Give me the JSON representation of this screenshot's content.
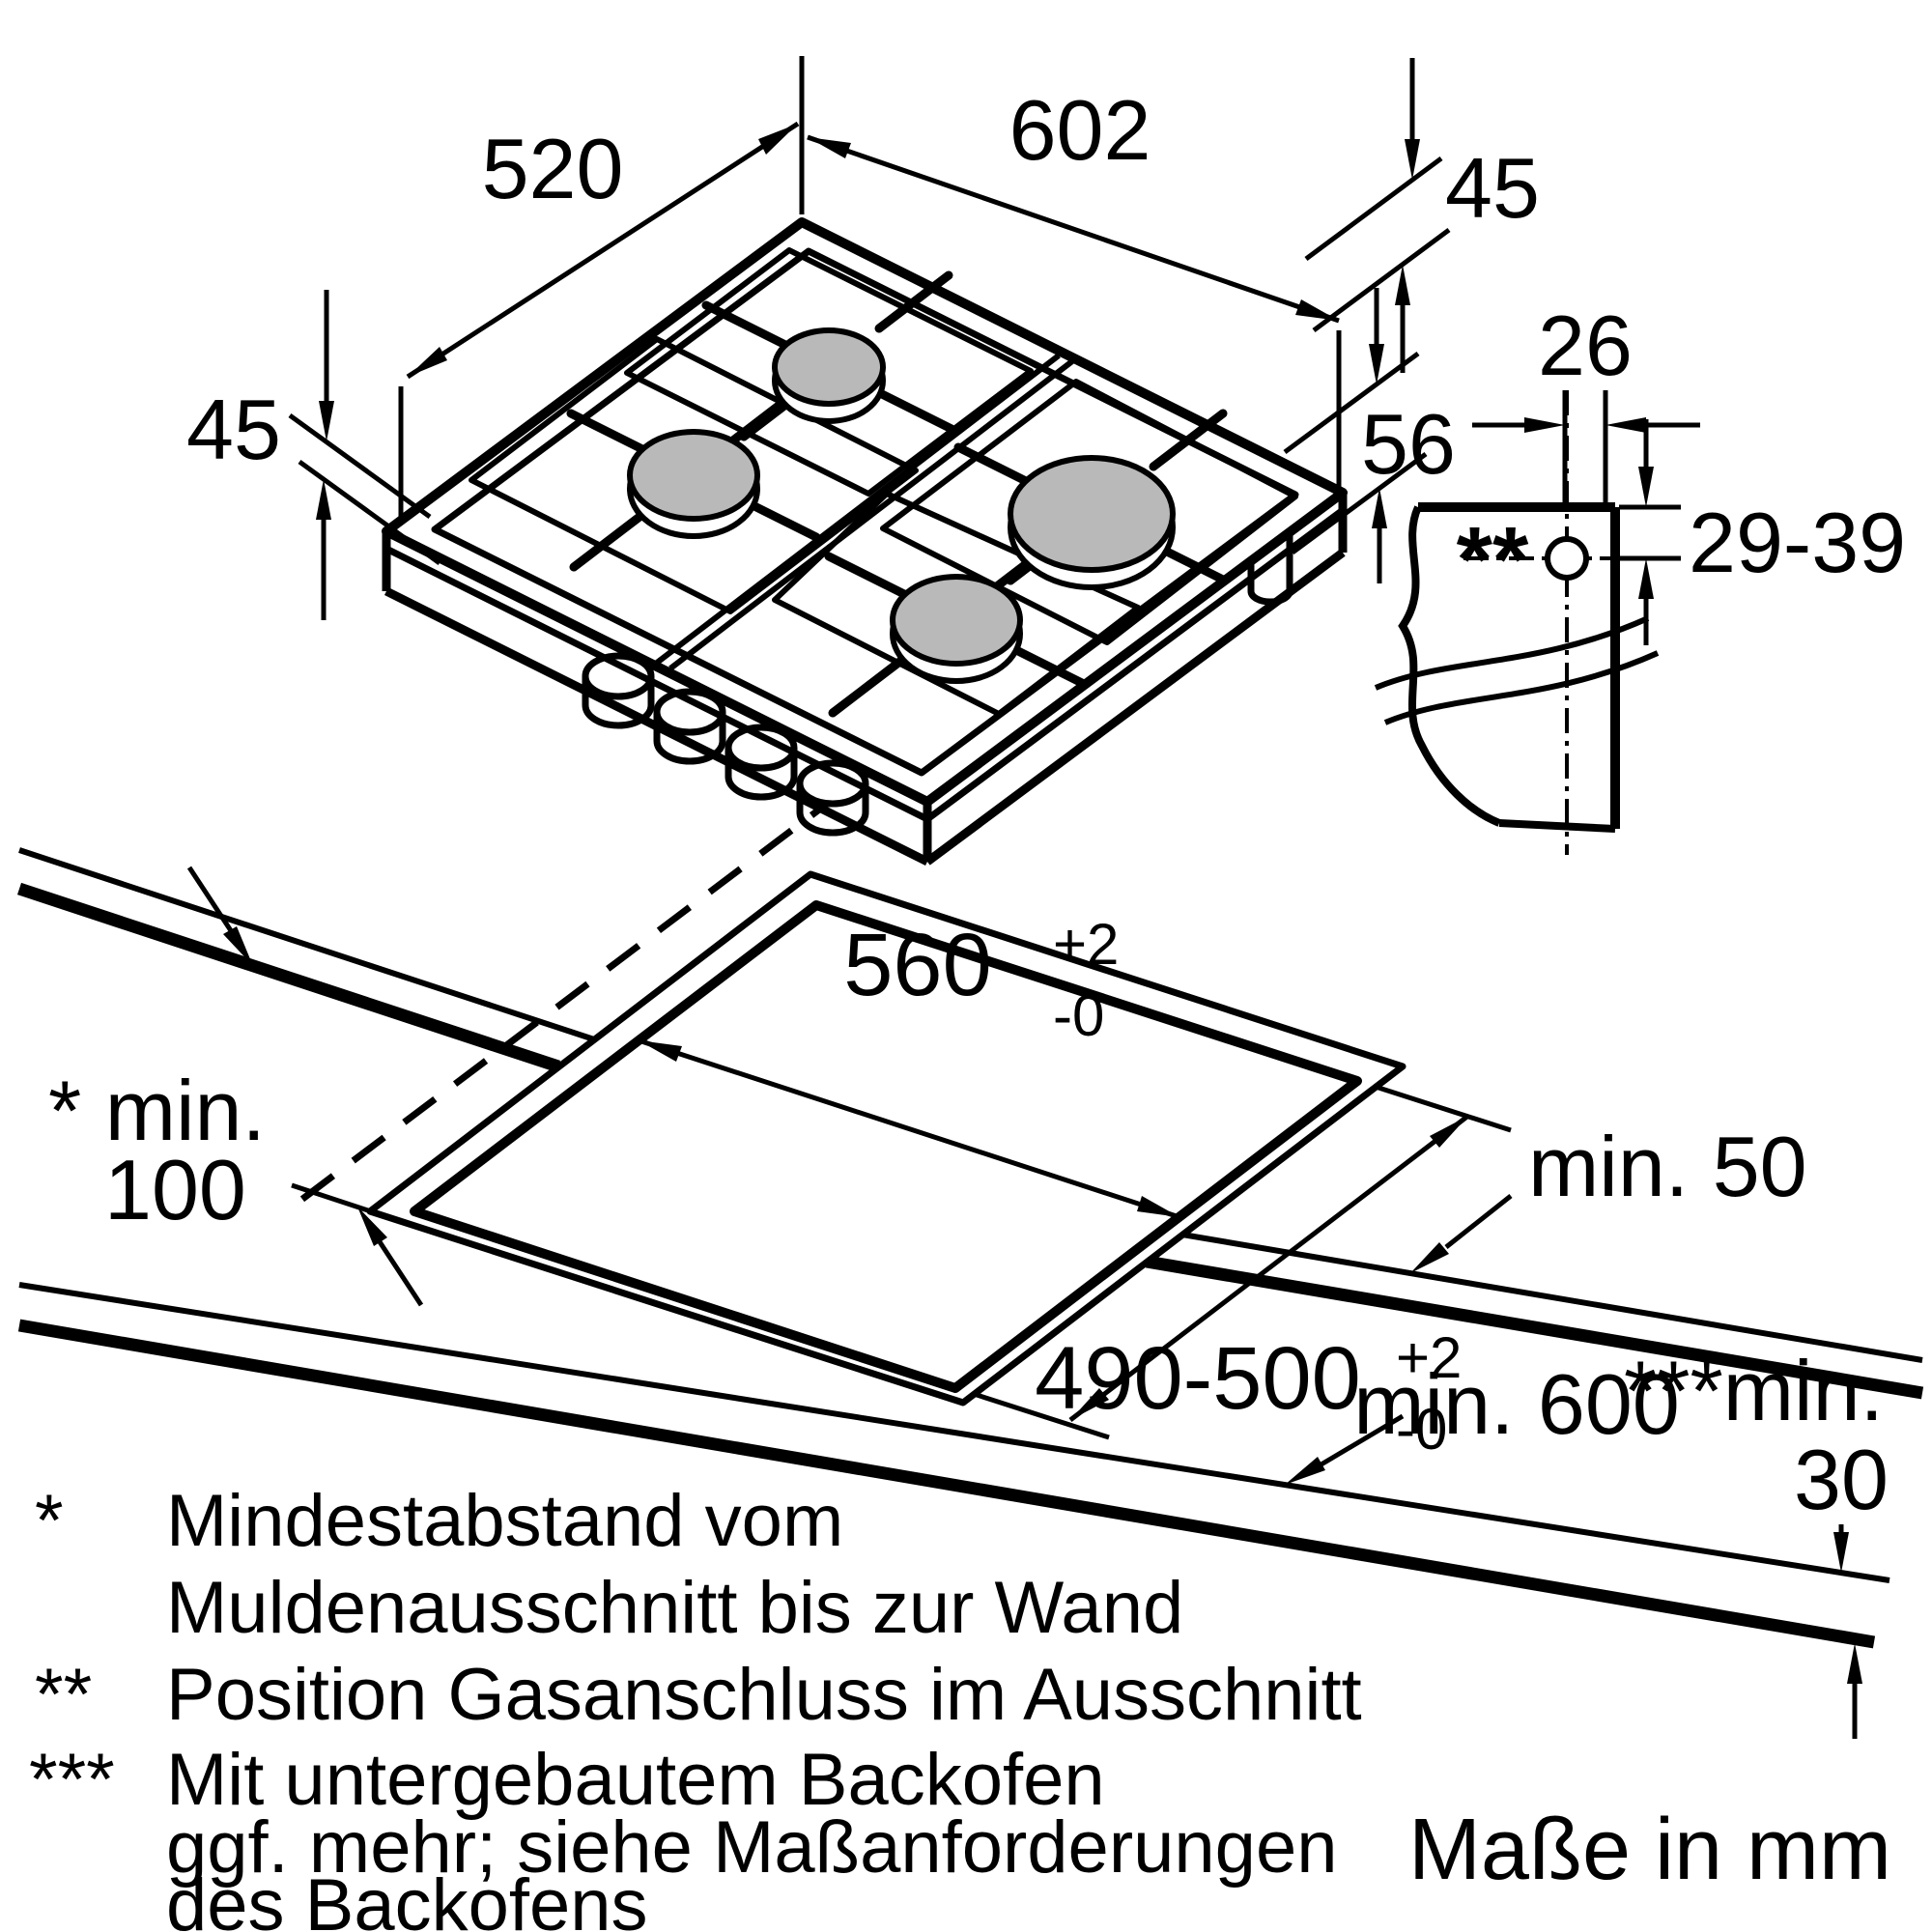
{
  "page": {
    "background": "#ffffff",
    "line_color": "#000000",
    "burner_fill": "#b9b9b9"
  },
  "hob": {
    "width_label": "602",
    "depth_label": "520",
    "height_left_label": "45",
    "height_right_label": "45",
    "below_worktop_label": "56"
  },
  "detail": {
    "gas_offset_label": "26",
    "gas_depth_label": "29-39",
    "marker": "**"
  },
  "worktop": {
    "cutout_width": "560",
    "cutout_width_tol_plus": "+2",
    "cutout_width_tol_minus": "-0",
    "cutout_depth": "490-500",
    "cutout_depth_tol_plus": "+2",
    "cutout_depth_tol_minus": "-0",
    "min_side": "min. 50",
    "min_wall_label": "* min.",
    "min_wall_value": "100",
    "min_depth": "min. 600",
    "min_oven_label": "***min.",
    "min_oven_value": "30"
  },
  "footnotes": {
    "f1_marker": "*",
    "f1_line1": "Mindestabstand vom",
    "f1_line2": "Muldenausschnitt bis zur Wand",
    "f2_marker": "**",
    "f2_line1": "Position Gasanschluss im Ausschnitt",
    "f3_marker": "***",
    "f3_line1": "Mit untergebautem Backofen",
    "f3_line2": "ggf. mehr; siehe Maßanforderungen",
    "f3_line3": "des Backofens"
  },
  "units_note": "Maße in mm"
}
